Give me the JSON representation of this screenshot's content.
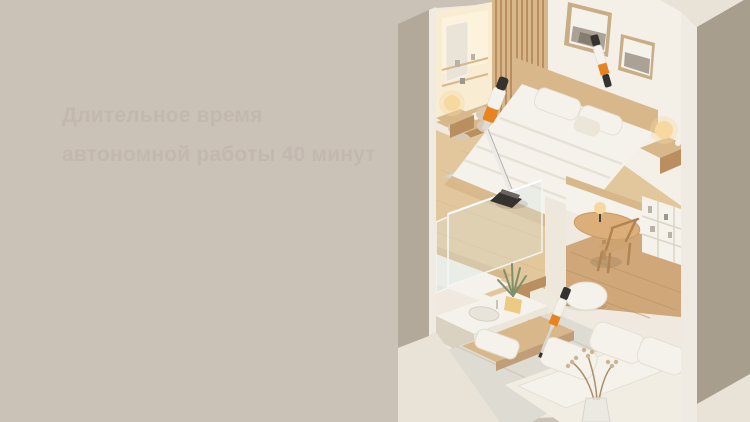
{
  "hero": {
    "ghost_heading_line1": "Длительное время",
    "ghost_heading_line2": "автономной работы 40 минут"
  },
  "palette": {
    "bg": "#cac1b7",
    "left_wall": "#b3a99a",
    "cut_edge": "#f0ebe2",
    "interior_backdrop": "#efe9df",
    "interior_wall": "#f4f0e8",
    "niche": "#f8ecd3",
    "niche_glow": "#fdf3dc",
    "wood_light": "#e3c79c",
    "wood_mid": "#d8b88a",
    "wood_dark": "#b98f60",
    "wood_floor_low": "#cfa778",
    "white_bright": "#f5f2ec",
    "white_soft": "#ebe5da",
    "shadow": "#d9d1c2",
    "rug": "#d8d5cd",
    "mat": "#dedbd2",
    "glass": "#d7e2dd",
    "taupe": "#a89e8e",
    "cream": "#e8e2d7",
    "orange": "#e8831f",
    "dark": "#35332f",
    "silver": "#dddcd8",
    "lamp_glow": "#f7d9a0",
    "photo": "#aaa296",
    "frame_wood": "#c9ae85",
    "chair_fabric": "#d9c9b4",
    "leaf": "#7e906b",
    "pot": "#ecca82"
  }
}
